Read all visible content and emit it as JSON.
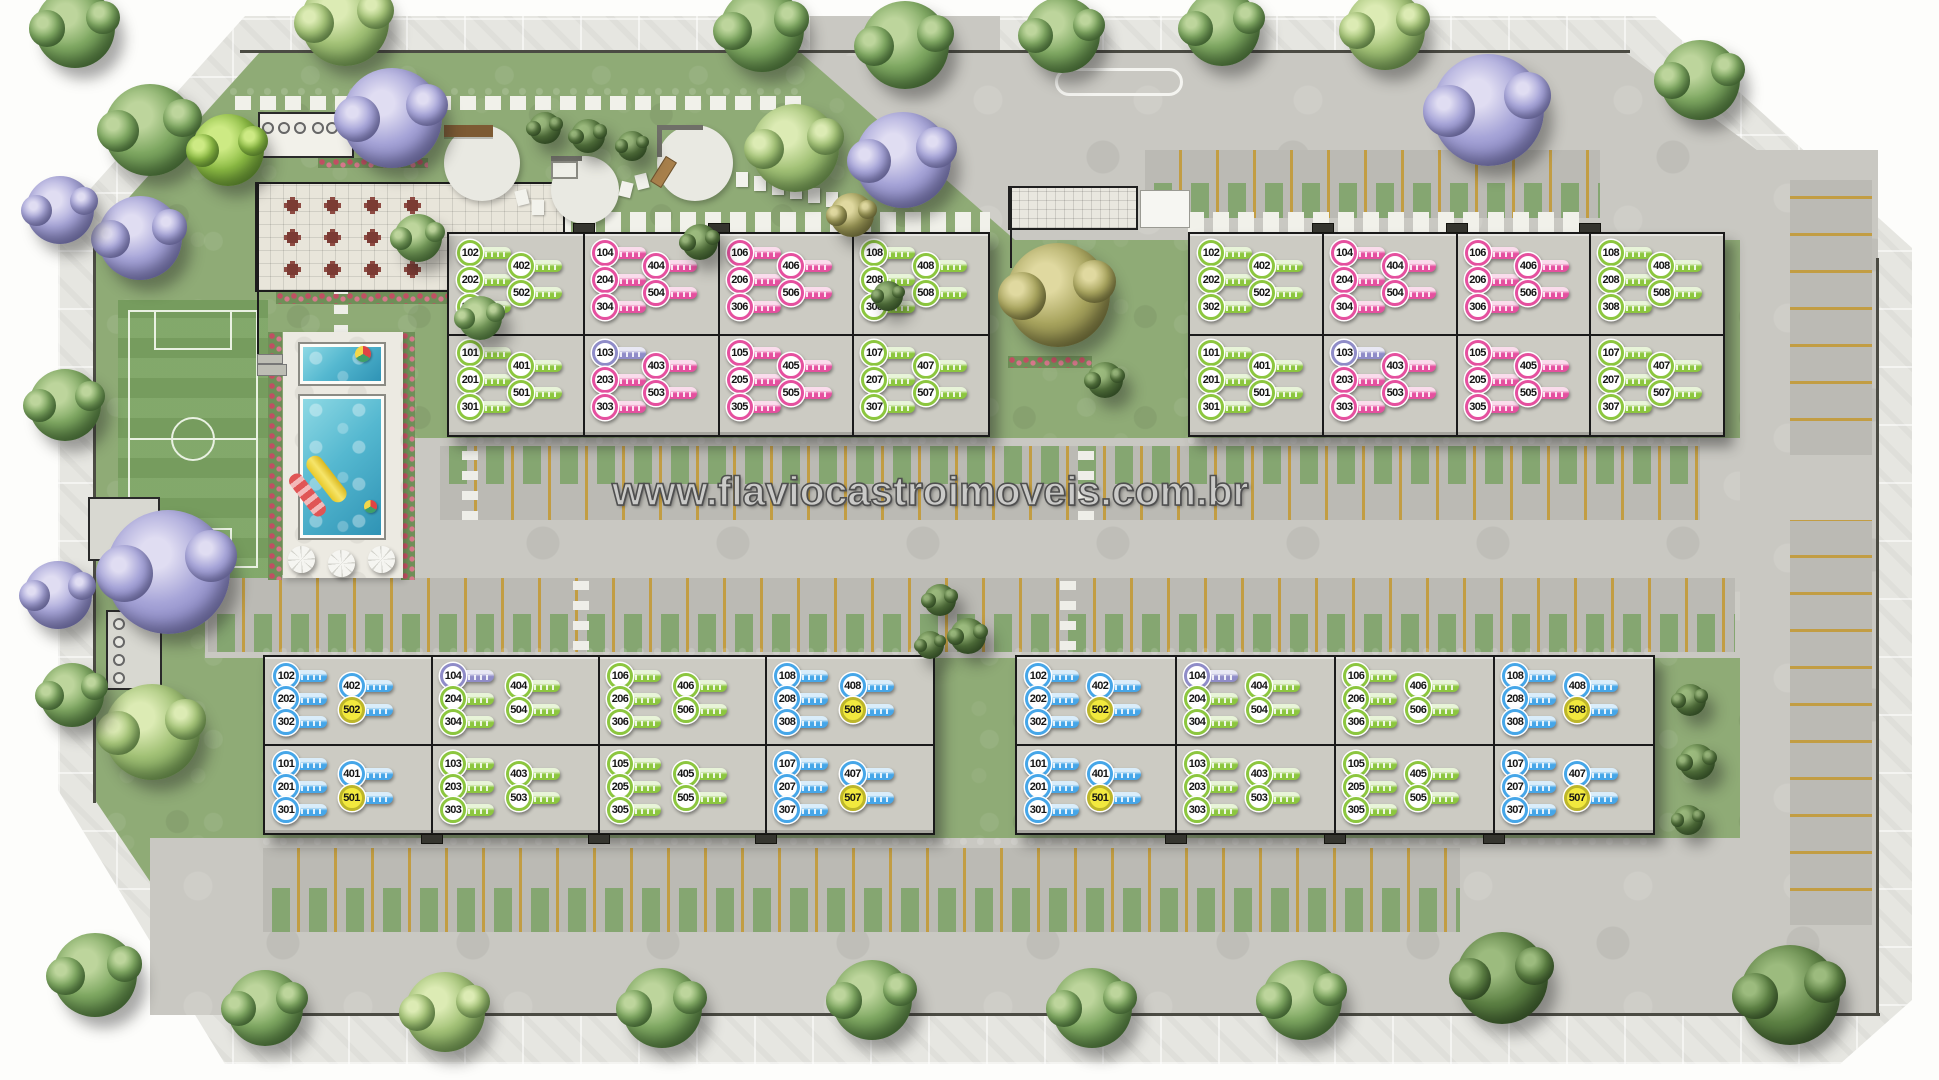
{
  "watermark": "www.flaviocastroimoveis.com.br",
  "key_colors": {
    "g": "#8cc63f",
    "p": "#e5509f",
    "u": "#8f8cc8",
    "b": "#46a6e8",
    "y": "#46a6e8"
  },
  "key_color_legend": {
    "g": "green-key",
    "p": "pink-key",
    "u": "purple-key",
    "b": "blue-key",
    "y": "yellow-head-blue-key"
  },
  "buildings": [
    {
      "id": "block-1",
      "position": "top-left",
      "sections": [
        {
          "upper": [
            "102:g",
            "202:g",
            "302:g",
            "402:g",
            "502:g"
          ],
          "lower": [
            "101:g",
            "201:g",
            "301:g",
            "401:g",
            "501:g"
          ]
        },
        {
          "upper": [
            "104:p",
            "204:p",
            "304:p",
            "404:p",
            "504:p"
          ],
          "lower": [
            "103:u",
            "203:p",
            "303:p",
            "403:p",
            "503:p"
          ]
        },
        {
          "upper": [
            "106:p",
            "206:p",
            "306:p",
            "406:p",
            "506:p"
          ],
          "lower": [
            "105:p",
            "205:p",
            "305:p",
            "405:p",
            "505:p"
          ]
        },
        {
          "upper": [
            "108:g",
            "208:g",
            "308:g",
            "408:g",
            "508:g"
          ],
          "lower": [
            "107:g",
            "207:g",
            "307:g",
            "407:g",
            "507:g"
          ]
        }
      ]
    },
    {
      "id": "block-2",
      "position": "top-right",
      "sections": [
        {
          "upper": [
            "102:g",
            "202:g",
            "302:g",
            "402:g",
            "502:g"
          ],
          "lower": [
            "101:g",
            "201:g",
            "301:g",
            "401:g",
            "501:g"
          ]
        },
        {
          "upper": [
            "104:p",
            "204:p",
            "304:p",
            "404:p",
            "504:p"
          ],
          "lower": [
            "103:u",
            "203:p",
            "303:p",
            "403:p",
            "503:p"
          ]
        },
        {
          "upper": [
            "106:p",
            "206:p",
            "306:p",
            "406:p",
            "506:p"
          ],
          "lower": [
            "105:p",
            "205:p",
            "305:p",
            "405:p",
            "505:p"
          ]
        },
        {
          "upper": [
            "108:g",
            "208:g",
            "308:g",
            "408:g",
            "508:g"
          ],
          "lower": [
            "107:g",
            "207:g",
            "307:g",
            "407:g",
            "507:g"
          ]
        }
      ]
    },
    {
      "id": "block-3",
      "position": "bottom-left",
      "sections": [
        {
          "upper": [
            "102:b",
            "202:b",
            "302:b",
            "402:b",
            "502:y"
          ],
          "lower": [
            "101:b",
            "201:b",
            "301:b",
            "401:b",
            "501:y"
          ]
        },
        {
          "upper": [
            "104:u",
            "204:g",
            "304:g",
            "404:g",
            "504:g"
          ],
          "lower": [
            "103:g",
            "203:g",
            "303:g",
            "403:g",
            "503:g"
          ]
        },
        {
          "upper": [
            "106:g",
            "206:g",
            "306:g",
            "406:g",
            "506:g"
          ],
          "lower": [
            "105:g",
            "205:g",
            "305:g",
            "405:g",
            "505:g"
          ]
        },
        {
          "upper": [
            "108:b",
            "208:b",
            "308:b",
            "408:b",
            "508:y"
          ],
          "lower": [
            "107:b",
            "207:b",
            "307:b",
            "407:b",
            "507:y"
          ]
        }
      ]
    },
    {
      "id": "block-4",
      "position": "bottom-right",
      "sections": [
        {
          "upper": [
            "102:b",
            "202:b",
            "302:b",
            "402:b",
            "502:y"
          ],
          "lower": [
            "101:b",
            "201:b",
            "301:b",
            "401:b",
            "501:y"
          ]
        },
        {
          "upper": [
            "104:u",
            "204:g",
            "304:g",
            "404:g",
            "504:g"
          ],
          "lower": [
            "103:g",
            "203:g",
            "303:g",
            "403:g",
            "503:g"
          ]
        },
        {
          "upper": [
            "106:g",
            "206:g",
            "306:g",
            "406:g",
            "506:g"
          ],
          "lower": [
            "105:g",
            "205:g",
            "305:g",
            "405:g",
            "505:g"
          ]
        },
        {
          "upper": [
            "108:b",
            "208:b",
            "308:b",
            "408:b",
            "508:y"
          ],
          "lower": [
            "107:b",
            "207:b",
            "307:b",
            "407:b",
            "507:y"
          ]
        }
      ]
    }
  ]
}
